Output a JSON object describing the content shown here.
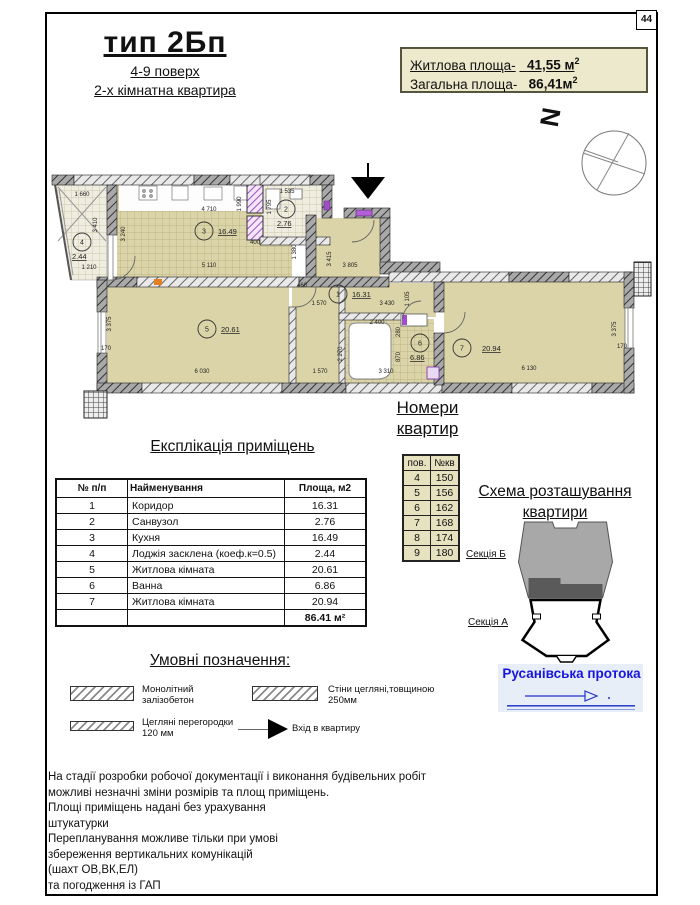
{
  "page_number": "44",
  "title": {
    "main": "тип 2Бп",
    "sub1": "4-9 поверх",
    "sub2": "2-х кімнатна квартира"
  },
  "area_box": {
    "line1_label": "Житлова площа-",
    "line1_value": "41,55 м",
    "line1_sup": "2",
    "line2_label": "Загальна площа-",
    "line2_value": "86,41м",
    "line2_sup": "2"
  },
  "north_letter": "N",
  "plan": {
    "rooms": [
      {
        "n": "1",
        "cx": 294,
        "cy": 131,
        "area": "16.31",
        "ax": 308,
        "ay": 134
      },
      {
        "n": "2",
        "cx": 242,
        "cy": 46,
        "area": "2.76",
        "ax": 233,
        "ay": 63
      },
      {
        "n": "3",
        "cx": 160,
        "cy": 68,
        "area": "16.49",
        "ax": 174,
        "ay": 71
      },
      {
        "n": "4",
        "cx": 38,
        "cy": 79,
        "area": "2.44",
        "ax": 28,
        "ay": 96
      },
      {
        "n": "5",
        "cx": 163,
        "cy": 166,
        "area": "20.61",
        "ax": 177,
        "ay": 169
      },
      {
        "n": "6",
        "cx": 376,
        "cy": 180,
        "area": "6.86",
        "ax": 366,
        "ay": 197
      },
      {
        "n": "7",
        "cx": 418,
        "cy": 185,
        "area": "20.94",
        "ax": 438,
        "ay": 188
      }
    ],
    "dims": [
      {
        "t": "1 660",
        "x": 38,
        "y": 33
      },
      {
        "t": "3 410",
        "x": 53,
        "y": 62,
        "r": 1
      },
      {
        "t": "4 710",
        "x": 165,
        "y": 48
      },
      {
        "t": "1 990",
        "x": 197,
        "y": 41,
        "r": 1
      },
      {
        "t": "1 535",
        "x": 243,
        "y": 30
      },
      {
        "t": "1 795",
        "x": 227,
        "y": 44,
        "r": 1
      },
      {
        "t": "3 240",
        "x": 81,
        "y": 71,
        "r": 1
      },
      {
        "t": "5 110",
        "x": 165,
        "y": 104
      },
      {
        "t": "1 380",
        "x": 252,
        "y": 89,
        "r": 1
      },
      {
        "t": "400",
        "x": 211,
        "y": 81
      },
      {
        "t": "1 210",
        "x": 45,
        "y": 106
      },
      {
        "t": "3 415",
        "x": 287,
        "y": 96,
        "r": 1
      },
      {
        "t": "3 805",
        "x": 306,
        "y": 104
      },
      {
        "t": "460",
        "x": 258,
        "y": 124
      },
      {
        "t": "1 570",
        "x": 275,
        "y": 142
      },
      {
        "t": "3 430",
        "x": 343,
        "y": 142
      },
      {
        "t": "1 105",
        "x": 365,
        "y": 136,
        "r": 1
      },
      {
        "t": "3 375",
        "x": 67,
        "y": 161,
        "r": 1
      },
      {
        "t": "170",
        "x": 62,
        "y": 187
      },
      {
        "t": "6 030",
        "x": 158,
        "y": 210
      },
      {
        "t": "1 570",
        "x": 276,
        "y": 210
      },
      {
        "t": "2 400",
        "x": 333,
        "y": 161
      },
      {
        "t": "2 270",
        "x": 298,
        "y": 191,
        "r": 1
      },
      {
        "t": "280",
        "x": 356,
        "y": 169,
        "r": 1
      },
      {
        "t": "870",
        "x": 356,
        "y": 194,
        "r": 1
      },
      {
        "t": "3 310",
        "x": 342,
        "y": 210
      },
      {
        "t": "6 130",
        "x": 485,
        "y": 207
      },
      {
        "t": "3 375",
        "x": 572,
        "y": 166,
        "r": 1
      },
      {
        "t": "170",
        "x": 578,
        "y": 185
      }
    ]
  },
  "apt_numbers": {
    "title_line1": "Номери",
    "title_line2": "квартир",
    "headers": [
      "пов.",
      "№кв"
    ],
    "rows": [
      [
        "4",
        "150"
      ],
      [
        "5",
        "156"
      ],
      [
        "6",
        "162"
      ],
      [
        "7",
        "168"
      ],
      [
        "8",
        "174"
      ],
      [
        "9",
        "180"
      ]
    ]
  },
  "explication": {
    "title": "Експлікація приміщень",
    "headers": [
      "№  п/п",
      "Найменування",
      "Площа, м2"
    ],
    "rows": [
      [
        "1",
        "Коридор",
        "16.31"
      ],
      [
        "2",
        "Санвузол",
        "2.76"
      ],
      [
        "3",
        "Кухня",
        "16.49"
      ],
      [
        "4",
        "Лоджія засклена (коеф.к=0.5)",
        "2.44"
      ],
      [
        "5",
        "Житлова кімната",
        "20.61"
      ],
      [
        "6",
        "Ванна",
        "6.86"
      ],
      [
        "7",
        "Житлова кімната",
        "20.94"
      ]
    ],
    "total": "86.41 м²"
  },
  "schema": {
    "title_line1": "Схема розташування",
    "title_line2": "квартири",
    "section_b": "Секція Б",
    "section_a": "Секція А",
    "river": "Русанівська протока"
  },
  "legend": {
    "title": "Умовні позначення:",
    "item1": "Монолітний\nзалізобетон",
    "item2": "Стіни цегляні,товщиною\n250мм",
    "item3": "Цегляні перегородки\n120 мм",
    "item4": "Вхід в квартиру"
  },
  "notes": [
    "На стадії розробки робочої документації і виконання будівельних робіт",
    "можливі незначні зміни  розмірів та площ приміщень.",
    "Площі приміщень надані без урахування",
    "штукатурки",
    "Перепланування можливе тільки при умові",
    "збереження вертикальних комунікацій",
    " (шахт ОВ,ВК,ЕЛ)",
    "та погодження із ГАП"
  ],
  "colors": {
    "floor_beige": "#dbd4a8",
    "box_beige": "#ece9cc",
    "table_beige": "#e6e1bf",
    "river_blue": "#1616dd",
    "accent_purple": "#a04fc8"
  }
}
